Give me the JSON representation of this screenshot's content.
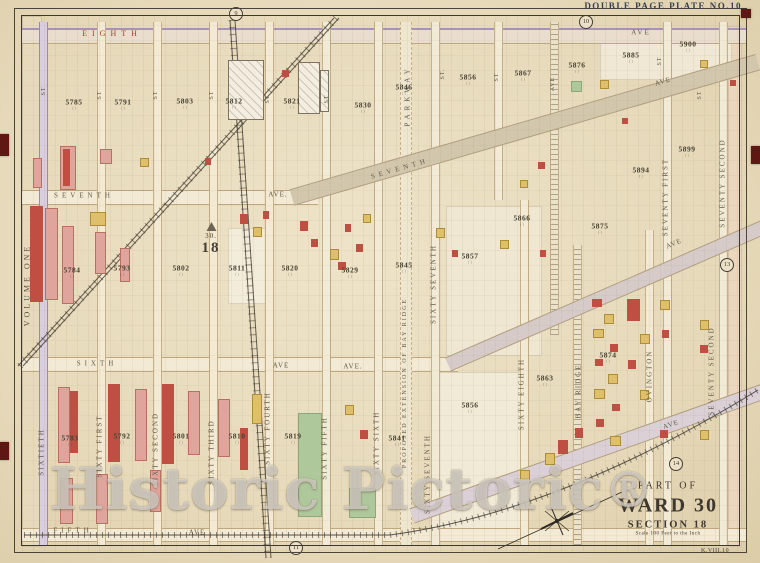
{
  "plate": {
    "title": "DOUBLE PAGE PLATE NO.10",
    "corner_code": "K.VIII.10",
    "volume_label": "VOLUME ONE"
  },
  "badges": [
    {
      "n": "9",
      "x": 236,
      "y": 14
    },
    {
      "n": "10",
      "x": 586,
      "y": 22
    },
    {
      "n": "11",
      "x": 296,
      "y": 548
    },
    {
      "n": "13",
      "x": 727,
      "y": 265
    },
    {
      "n": "14",
      "x": 676,
      "y": 464
    }
  ],
  "cartouche": {
    "line1": "PART OF",
    "line2": "WARD 30",
    "line3": "SECTION 18",
    "line4": "Scale 100 Feet to the Inch"
  },
  "section_marker": {
    "ward": "30.",
    "section": "18"
  },
  "watermark": {
    "text": "Historic Pictoric",
    "reg": "®"
  },
  "labels": [
    {
      "t": "EIGHTH",
      "x": 112,
      "y": 34,
      "s": 8,
      "ls": 5,
      "c": "red"
    },
    {
      "t": "AVE",
      "x": 641,
      "y": 33,
      "s": 7,
      "ls": 2
    },
    {
      "t": "SEVENTH",
      "x": 84,
      "y": 196,
      "s": 7,
      "ls": 4
    },
    {
      "t": "AVE.",
      "x": 278,
      "y": 195,
      "s": 7,
      "ls": 1
    },
    {
      "t": "SEVENTH",
      "x": 400,
      "y": 169,
      "s": 7,
      "ls": 4,
      "r": -16
    },
    {
      "t": "AVE",
      "x": 663,
      "y": 82,
      "s": 7,
      "ls": 1,
      "r": -16
    },
    {
      "t": "SIXTH",
      "x": 97,
      "y": 364,
      "s": 7,
      "ls": 4
    },
    {
      "t": "AVE",
      "x": 281,
      "y": 366,
      "s": 7,
      "ls": 1
    },
    {
      "t": "AVE.",
      "x": 353,
      "y": 367,
      "s": 7,
      "ls": 1
    },
    {
      "t": "AVE",
      "x": 674,
      "y": 244,
      "s": 7,
      "ls": 1,
      "r": -23
    },
    {
      "t": "FIFTH",
      "x": 73,
      "y": 531,
      "s": 7,
      "ls": 4
    },
    {
      "t": "AVE",
      "x": 197,
      "y": 533,
      "s": 7,
      "ls": 1
    },
    {
      "t": "AVE",
      "x": 671,
      "y": 425,
      "s": 7,
      "ls": 1,
      "r": -19
    },
    {
      "t": "SIXTIETH",
      "x": 42,
      "y": 452,
      "v": 1
    },
    {
      "t": "SIXTY FIRST",
      "x": 100,
      "y": 446,
      "v": 1
    },
    {
      "t": "SIXTY SECOND",
      "x": 156,
      "y": 449,
      "v": 1
    },
    {
      "t": "SIXTY THIRD",
      "x": 212,
      "y": 452,
      "v": 1
    },
    {
      "t": "SIXTY FOURTH",
      "x": 268,
      "y": 428,
      "v": 1
    },
    {
      "t": "SIXTY FIFTH",
      "x": 325,
      "y": 448,
      "v": 1
    },
    {
      "t": "SIXTY SIXTH",
      "x": 377,
      "y": 443,
      "v": 1
    },
    {
      "t": "SIXTY SEVENTH",
      "x": 434,
      "y": 284,
      "v": 1
    },
    {
      "t": "SIXTY SEVENTH",
      "x": 428,
      "y": 474,
      "v": 1
    },
    {
      "t": "SIXTY EIGHTH",
      "x": 522,
      "y": 394,
      "v": 1
    },
    {
      "t": "BAY RIDGE",
      "x": 579,
      "y": 391,
      "v": 1
    },
    {
      "t": "OVINGTON",
      "x": 650,
      "y": 376,
      "v": 1
    },
    {
      "t": "SEVENTY FIRST",
      "x": 666,
      "y": 197,
      "v": 1
    },
    {
      "t": "SEVENTY SECOND",
      "x": 723,
      "y": 183,
      "v": 1
    },
    {
      "t": "SEVENTY SECOND",
      "x": 712,
      "y": 371,
      "v": 1
    },
    {
      "t": "PARKWAY",
      "x": 408,
      "y": 96,
      "v": 1,
      "ls": 4
    },
    {
      "t": "PROPOSED EXTENSION OF BAY RIDGE",
      "x": 405,
      "y": 383,
      "v": 1,
      "s": 6,
      "ls": 2
    },
    {
      "t": "AVE",
      "x": 553,
      "y": 84,
      "v": 1,
      "s": 6,
      "ls": 1
    },
    {
      "t": "ST",
      "x": 44,
      "y": 91,
      "v": 1,
      "s": 6,
      "ls": 1
    },
    {
      "t": "ST",
      "x": 100,
      "y": 95,
      "v": 1,
      "s": 6,
      "ls": 1
    },
    {
      "t": "ST",
      "x": 156,
      "y": 95,
      "v": 1,
      "s": 6,
      "ls": 1
    },
    {
      "t": "ST",
      "x": 212,
      "y": 95,
      "v": 1,
      "s": 6,
      "ls": 1
    },
    {
      "t": "ST",
      "x": 268,
      "y": 99,
      "v": 1,
      "s": 6,
      "ls": 1
    },
    {
      "t": "ST",
      "x": 327,
      "y": 99,
      "v": 1,
      "s": 6,
      "ls": 1
    },
    {
      "t": "ST.",
      "x": 443,
      "y": 74,
      "v": 1,
      "s": 6,
      "ls": 1
    },
    {
      "t": "ST",
      "x": 497,
      "y": 77,
      "v": 1,
      "s": 6,
      "ls": 1
    },
    {
      "t": "ST",
      "x": 660,
      "y": 61,
      "v": 1,
      "s": 6,
      "ls": 1
    },
    {
      "t": "ST",
      "x": 700,
      "y": 95,
      "v": 1,
      "s": 6,
      "ls": 1
    }
  ],
  "block_numbers": [
    {
      "n": "5785",
      "x": 74,
      "y": 104
    },
    {
      "n": "5791",
      "x": 123,
      "y": 104
    },
    {
      "n": "5803",
      "x": 185,
      "y": 103
    },
    {
      "n": "5812",
      "x": 234,
      "y": 103
    },
    {
      "n": "5821",
      "x": 292,
      "y": 103
    },
    {
      "n": "5830",
      "x": 363,
      "y": 107
    },
    {
      "n": "5846",
      "x": 404,
      "y": 89
    },
    {
      "n": "5856",
      "x": 468,
      "y": 79
    },
    {
      "n": "5867",
      "x": 523,
      "y": 75
    },
    {
      "n": "5876",
      "x": 577,
      "y": 67
    },
    {
      "n": "5885",
      "x": 631,
      "y": 57
    },
    {
      "n": "5900",
      "x": 688,
      "y": 46
    },
    {
      "n": "5784",
      "x": 72,
      "y": 272
    },
    {
      "n": "5793",
      "x": 122,
      "y": 270
    },
    {
      "n": "5802",
      "x": 181,
      "y": 270
    },
    {
      "n": "5811",
      "x": 237,
      "y": 270
    },
    {
      "n": "5820",
      "x": 290,
      "y": 270
    },
    {
      "n": "5829",
      "x": 350,
      "y": 272
    },
    {
      "n": "5845",
      "x": 404,
      "y": 267
    },
    {
      "n": "5857",
      "x": 470,
      "y": 258
    },
    {
      "n": "5866",
      "x": 522,
      "y": 220
    },
    {
      "n": "5875",
      "x": 600,
      "y": 228
    },
    {
      "n": "5894",
      "x": 641,
      "y": 172
    },
    {
      "n": "5899",
      "x": 687,
      "y": 151
    },
    {
      "n": "5783",
      "x": 70,
      "y": 440
    },
    {
      "n": "5792",
      "x": 122,
      "y": 438
    },
    {
      "n": "5801",
      "x": 181,
      "y": 438
    },
    {
      "n": "5810",
      "x": 237,
      "y": 438
    },
    {
      "n": "5819",
      "x": 293,
      "y": 438
    },
    {
      "n": "5841",
      "x": 397,
      "y": 440
    },
    {
      "n": "5856",
      "x": 470,
      "y": 407
    },
    {
      "n": "5863",
      "x": 545,
      "y": 380
    },
    {
      "n": "5874",
      "x": 608,
      "y": 357
    }
  ],
  "geometry": {
    "avenues": [
      {
        "y": 28,
        "h": 13,
        "x1": 22,
        "x2": 746,
        "lav": 1
      },
      {
        "y": 190,
        "h": 13,
        "x1": 22,
        "x2": 318
      },
      {
        "y": 357,
        "h": 13,
        "x1": 22,
        "x2": 458
      },
      {
        "y": 528,
        "h": 12,
        "x1": 22,
        "x2": 746
      }
    ],
    "streets": [
      {
        "x": 42,
        "y1": 22,
        "y2": 545,
        "lav": 1
      },
      {
        "x": 100,
        "y1": 22,
        "y2": 545
      },
      {
        "x": 156,
        "y1": 22,
        "y2": 545
      },
      {
        "x": 212,
        "y1": 22,
        "y2": 545
      },
      {
        "x": 268,
        "y1": 22,
        "y2": 545
      },
      {
        "x": 325,
        "y1": 22,
        "y2": 545
      },
      {
        "x": 377,
        "y1": 22,
        "y2": 545
      },
      {
        "x": 405,
        "y1": 22,
        "y2": 545,
        "w": 10,
        "dash": 1
      },
      {
        "x": 434,
        "y1": 22,
        "y2": 545
      },
      {
        "x": 497,
        "y1": 22,
        "y2": 200
      },
      {
        "x": 523,
        "y1": 200,
        "y2": 545
      },
      {
        "x": 553,
        "y1": 22,
        "y2": 335,
        "hatch": 1
      },
      {
        "x": 576,
        "y1": 245,
        "y2": 545,
        "hatch": 1
      },
      {
        "x": 648,
        "y1": 230,
        "y2": 545
      },
      {
        "x": 666,
        "y1": 22,
        "y2": 545
      },
      {
        "x": 722,
        "y1": 22,
        "y2": 545
      }
    ],
    "diagonals": [
      {
        "x": 292,
        "y": 189,
        "len": 485,
        "h": 15,
        "rot": -16.2,
        "bg": "#d2c7ad"
      },
      {
        "x": 448,
        "y": 357,
        "len": 350,
        "h": 13,
        "rot": -23.5,
        "bg": "#d6cbc8"
      },
      {
        "x": 412,
        "y": 508,
        "len": 392,
        "h": 14,
        "rot": -19.5,
        "bg": "#dbd0d6"
      }
    ],
    "plots": [
      [
        22,
        16,
        18,
        529,
        "#e7dabb"
      ],
      [
        728,
        26,
        12,
        519,
        "#ead7bd"
      ],
      [
        433,
        372,
        88,
        158,
        "#f1ead6"
      ],
      [
        446,
        206,
        94,
        148,
        "#efe7d2"
      ],
      [
        228,
        228,
        36,
        74,
        "#f2ecdb"
      ],
      [
        600,
        36,
        130,
        42,
        "#f0e8d4"
      ]
    ],
    "buildings": [
      [
        33,
        158,
        7,
        28,
        "p"
      ],
      [
        60,
        146,
        14,
        42,
        "p"
      ],
      [
        63,
        149,
        7,
        37,
        "r"
      ],
      [
        100,
        149,
        10,
        13,
        "p"
      ],
      [
        140,
        158,
        7,
        7,
        "y"
      ],
      [
        205,
        158,
        6,
        7,
        "r"
      ],
      [
        282,
        70,
        7,
        7,
        "r"
      ],
      [
        228,
        60,
        34,
        58,
        "w"
      ],
      [
        298,
        62,
        20,
        50,
        "w"
      ],
      [
        320,
        70,
        7,
        40,
        "w"
      ],
      [
        30,
        206,
        13,
        96,
        "r"
      ],
      [
        45,
        208,
        11,
        90,
        "p"
      ],
      [
        62,
        226,
        10,
        76,
        "p"
      ],
      [
        90,
        212,
        14,
        12,
        "y"
      ],
      [
        95,
        232,
        9,
        40,
        "p"
      ],
      [
        120,
        248,
        8,
        32,
        "p"
      ],
      [
        240,
        214,
        8,
        10,
        "r"
      ],
      [
        253,
        227,
        7,
        8,
        "y"
      ],
      [
        263,
        211,
        6,
        8,
        "r"
      ],
      [
        300,
        221,
        8,
        10,
        "r"
      ],
      [
        311,
        239,
        7,
        8,
        "r"
      ],
      [
        330,
        249,
        7,
        9,
        "y"
      ],
      [
        345,
        224,
        6,
        8,
        "r"
      ],
      [
        356,
        244,
        7,
        8,
        "r"
      ],
      [
        363,
        214,
        6,
        7,
        "y"
      ],
      [
        338,
        262,
        8,
        8,
        "r"
      ],
      [
        436,
        228,
        7,
        8,
        "y"
      ],
      [
        452,
        250,
        6,
        7,
        "r"
      ],
      [
        500,
        240,
        7,
        7,
        "y"
      ],
      [
        540,
        250,
        6,
        7,
        "r"
      ],
      [
        538,
        162,
        7,
        7,
        "r"
      ],
      [
        520,
        180,
        6,
        6,
        "y"
      ],
      [
        600,
        80,
        7,
        7,
        "y"
      ],
      [
        622,
        118,
        6,
        6,
        "r"
      ],
      [
        592,
        299,
        10,
        8,
        "r"
      ],
      [
        604,
        314,
        8,
        8,
        "y"
      ],
      [
        593,
        329,
        9,
        7,
        "y"
      ],
      [
        610,
        344,
        8,
        8,
        "r"
      ],
      [
        595,
        359,
        8,
        7,
        "r"
      ],
      [
        608,
        374,
        8,
        8,
        "y"
      ],
      [
        594,
        389,
        9,
        8,
        "y"
      ],
      [
        612,
        404,
        8,
        7,
        "r"
      ],
      [
        596,
        419,
        8,
        8,
        "r"
      ],
      [
        610,
        436,
        9,
        8,
        "y"
      ],
      [
        627,
        299,
        13,
        22,
        "r"
      ],
      [
        640,
        334,
        8,
        8,
        "y"
      ],
      [
        628,
        360,
        8,
        9,
        "r"
      ],
      [
        640,
        390,
        7,
        8,
        "y"
      ],
      [
        660,
        300,
        8,
        8,
        "y"
      ],
      [
        662,
        330,
        7,
        8,
        "r"
      ],
      [
        700,
        320,
        7,
        8,
        "y"
      ],
      [
        700,
        345,
        8,
        8,
        "r"
      ],
      [
        660,
        430,
        8,
        8,
        "r"
      ],
      [
        700,
        430,
        7,
        8,
        "y"
      ],
      [
        730,
        80,
        6,
        6,
        "r"
      ],
      [
        700,
        60,
        6,
        6,
        "y"
      ],
      [
        58,
        387,
        10,
        74,
        "p"
      ],
      [
        70,
        391,
        8,
        62,
        "r"
      ],
      [
        108,
        384,
        12,
        78,
        "r"
      ],
      [
        135,
        389,
        10,
        70,
        "p"
      ],
      [
        162,
        384,
        12,
        80,
        "r"
      ],
      [
        188,
        391,
        10,
        62,
        "p"
      ],
      [
        218,
        399,
        10,
        56,
        "p"
      ],
      [
        240,
        428,
        8,
        42,
        "r"
      ],
      [
        252,
        394,
        8,
        28,
        "y"
      ],
      [
        60,
        478,
        11,
        44,
        "p"
      ],
      [
        96,
        474,
        10,
        48,
        "p"
      ],
      [
        150,
        470,
        9,
        40,
        "p"
      ],
      [
        360,
        430,
        8,
        9,
        "r"
      ],
      [
        345,
        405,
        7,
        8,
        "y"
      ],
      [
        545,
        453,
        8,
        10,
        "y"
      ],
      [
        558,
        440,
        10,
        14,
        "r"
      ],
      [
        575,
        428,
        8,
        10,
        "r"
      ],
      [
        520,
        470,
        8,
        8,
        "y"
      ]
    ],
    "greens": [
      [
        298,
        413,
        22,
        102
      ],
      [
        349,
        488,
        25,
        28
      ],
      [
        571,
        81,
        9,
        9
      ]
    ]
  },
  "palette": {
    "red_building": "#bf4f43",
    "pink_building": "#dfa49b",
    "yellow_building": "#dfc06a",
    "white_building": "#f4eee0",
    "dark_building": "#8a4a3c",
    "park_green": "#aec79b",
    "street_red_label": "#a8412c",
    "plate_title_blue": "#39404f",
    "tab_maroon": "#5e1712"
  }
}
